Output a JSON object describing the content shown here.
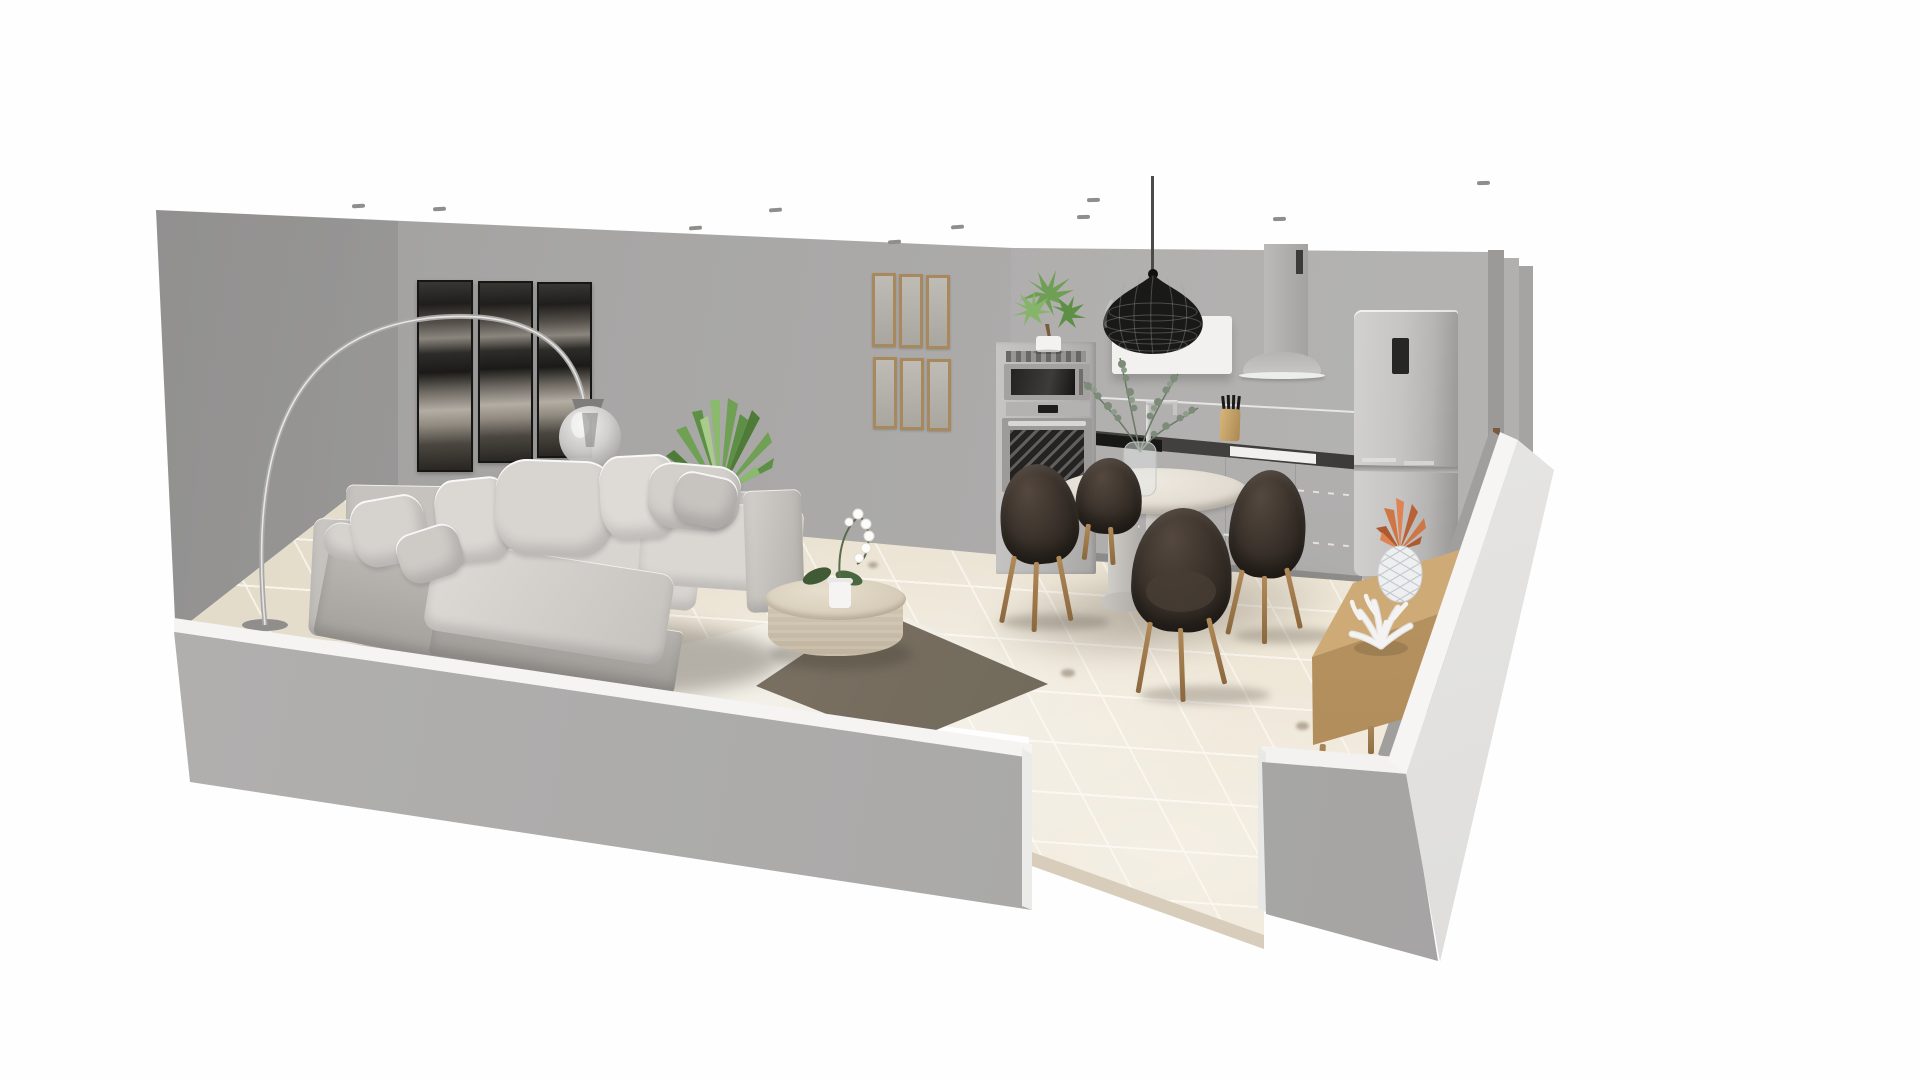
{
  "app": {
    "name": "3D home design viewport",
    "view": "perspective cut-away room render"
  },
  "scene": {
    "background": "#ffffff",
    "wall_color": "#a7a6a5",
    "wall_cap_color": "#f4f3f1",
    "floor_tile_color": "#eae2d2",
    "floor_grout_color": "#f8f3e8",
    "rooms": [
      "living room",
      "kitchen",
      "dining area"
    ],
    "spotlight_count": 10
  },
  "objects": {
    "sofa": {
      "label": "Light gray sectional sofa with chaise and cushions",
      "color": "#d4d1cd"
    },
    "arc_lamp": {
      "label": "Chrome arc floor lamp with glass globe shade",
      "color": "#bdbcbb"
    },
    "triptych": {
      "label": "Three panel abstract wall art",
      "panels": 3,
      "color": "#2b2926"
    },
    "wall_frames": {
      "label": "Grid of six wooden wall frames",
      "rows": 2,
      "cols": 3,
      "frame_color": "#a8895e"
    },
    "yucca": {
      "label": "Green yucca plant behind sofa",
      "color": "#6fa054"
    },
    "coffee_table": {
      "label": "Round travertine coffee table",
      "color": "#d4c9b6"
    },
    "orchid": {
      "label": "White orchid in white pot on coffee table",
      "color": "#fcfcfb"
    },
    "rug": {
      "label": "Cream area rug with dark overlay rug",
      "colors": [
        "#f4f1ea",
        "#6a635a"
      ]
    },
    "dining_table": {
      "label": "Round twin-pedestal dining table",
      "top_color": "#e6e1d8"
    },
    "dining_chairs": {
      "label": "Dark brown upholstered dining chairs with wood legs",
      "count": 4,
      "shell_color": "#352d27",
      "leg_color": "#a6855e"
    },
    "eucalyptus": {
      "label": "Eucalyptus stems in glass vase",
      "color": "#7d8c78"
    },
    "pendant": {
      "label": "Black woven pendant lamp over kitchen",
      "color": "#1d1c1b"
    },
    "wall_panel": {
      "label": "White wall panel behind pendant",
      "color": "#f2f1ef"
    },
    "oven_column": {
      "label": "Tall cabinet with built-in microwave and oven",
      "color": "#bcbbba"
    },
    "oven_plant": {
      "label": "Small potted tree on oven cabinet",
      "color": "#74a55a"
    },
    "hood": {
      "label": "Chimney extractor hood",
      "color": "#b0afae"
    },
    "counter": {
      "label": "Kitchen run with dark worktop, hob and sink",
      "top_color": "#2e2d2c",
      "cabinet_color": "#b0afae"
    },
    "faucet": {
      "label": "Chrome kitchen faucet",
      "color": "#d8d8d8"
    },
    "knife_block": {
      "label": "Wood knife block with black knives",
      "color": "#c8a96e"
    },
    "fridge": {
      "label": "Freestanding fridge freezer with display",
      "color": "#c0bfbe"
    },
    "sideboard": {
      "label": "Low oak sideboard on tapered legs",
      "color": "#c9a572"
    },
    "pineapple": {
      "label": "Ceramic pineapple ornament",
      "body_color": "#eceef0",
      "leaf_color": "#c96f42"
    },
    "coral": {
      "label": "White coral ornament",
      "color": "#f2f1ef"
    },
    "spotlights": {
      "label": "Recessed ceiling spotlights",
      "count": 10
    },
    "walls": {
      "label": "Gray room walls with white cut-away caps"
    },
    "floor": {
      "label": "Beige tiled floor"
    }
  }
}
